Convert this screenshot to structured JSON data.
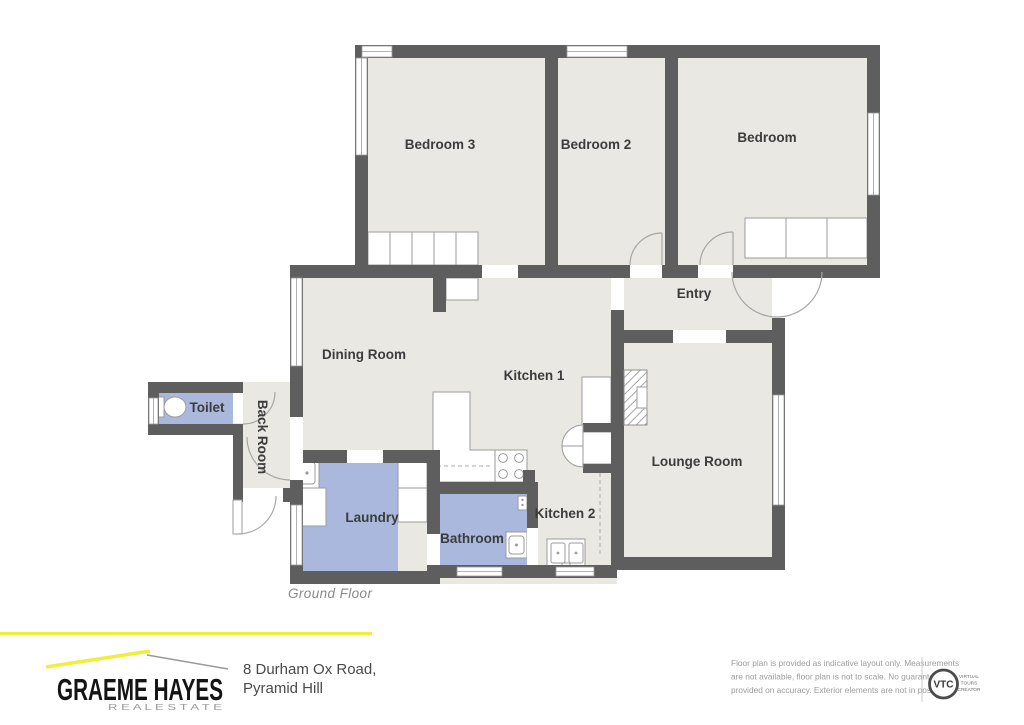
{
  "plan": {
    "floor_label": "Ground Floor",
    "rooms": {
      "bedroom3": "Bedroom 3",
      "bedroom2": "Bedroom 2",
      "bedroom": "Bedroom",
      "entry": "Entry",
      "dining": "Dining Room",
      "kitchen1": "Kitchen 1",
      "toilet": "Toilet",
      "backroom": "Back Room",
      "laundry": "Laundry",
      "bathroom": "Bathroom",
      "kitchen2": "Kitchen 2",
      "lounge": "Lounge Room"
    },
    "colors": {
      "wall": "#5e5e5e",
      "floor": "#e9e8e2",
      "wet_room_fill": "#a9b8dc",
      "accent_yellow": "#f0ee3c"
    }
  },
  "footer": {
    "brand_name": "GRAEME HAYES",
    "brand_tagline": "R E A L   E S T A T E",
    "address_line1": "8 Durham Ox Road,",
    "address_line2": "Pyramid Hill",
    "disclaimer": [
      "Floor plan is provided as indicative layout only. Measurements",
      "are not available, floor plan is not to scale. No guarantees",
      "provided on accuracy. Exterior elements are not in position"
    ],
    "vtc_abbr": "VTC",
    "vtc_words": [
      "VIRTUAL",
      "TOURS",
      "CREATOR"
    ]
  }
}
